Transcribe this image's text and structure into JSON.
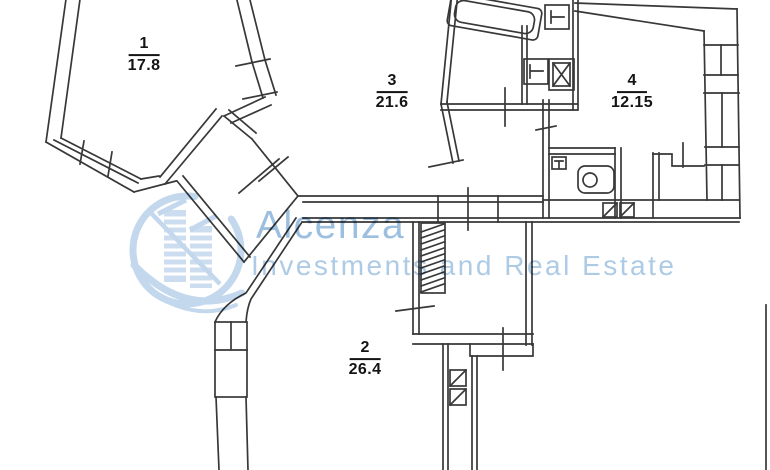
{
  "plan": {
    "type": "apartment-floor-plan",
    "background": "#ffffff",
    "line_color": "#383838",
    "rooms": [
      {
        "number": "1",
        "area": "17.8"
      },
      {
        "number": "2",
        "area": "26.4"
      },
      {
        "number": "3",
        "area": "21.6"
      },
      {
        "number": "4",
        "area": "12.15"
      }
    ],
    "fixtures": [
      "bathtub",
      "kitchen-sink",
      "wash-basin",
      "stove",
      "toilet",
      "ventilation-shaft",
      "ventilation-shaft",
      "duct-shaft",
      "duct-shaft",
      "built-in-wardrobe-hatch",
      "window-band",
      "window-band"
    ]
  },
  "watermark": {
    "brand": "Alcenza",
    "tagline": "Investments and Real Estate",
    "brand_color": "#9dbfdf",
    "tagline_color": "#aecbe6",
    "logo_color": "#b9d2ea"
  }
}
